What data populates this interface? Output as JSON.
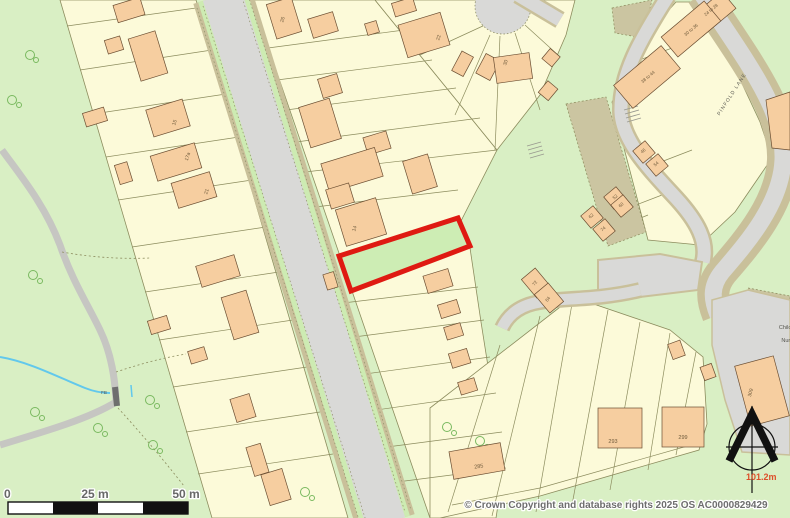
{
  "map": {
    "type": "os-site-plan",
    "copyright": "© Crown Copyright and database rights 2025 OS AC0000829429",
    "scale_bar": {
      "zero": "0",
      "mid": "25 m",
      "end": "50 m"
    },
    "spot_height": "101.2m",
    "street_name": "PINFOLD LANE",
    "plot_outline_color": "#DF1A12",
    "colors": {
      "open_green": "#D9EFC4",
      "parcel_cream": "#FCFAD9",
      "building_peach": "#F6CEA0",
      "road_grey": "#D9D9D7",
      "verge_green": "#CDEBB2",
      "road_casing": "#C9C09A",
      "scrub_khaki": "#CBC5A1",
      "stream_blue": "#62C8EC",
      "plot_red": "#DF1A12"
    },
    "labels": [
      {
        "id": "h15",
        "text": "15",
        "x": 176,
        "y": 123,
        "rot": -73,
        "size": 5,
        "color": "#6F5B3C"
      },
      {
        "id": "h17a",
        "text": "17a",
        "x": 189,
        "y": 157,
        "rot": -73,
        "size": 5,
        "color": "#6F5B3C"
      },
      {
        "id": "h21",
        "text": "21",
        "x": 208,
        "y": 192,
        "rot": -73,
        "size": 5,
        "color": "#6F5B3C"
      },
      {
        "id": "h26",
        "text": "26",
        "x": 284,
        "y": 20,
        "rot": -73,
        "size": 5,
        "color": "#6F5B3C"
      },
      {
        "id": "h22",
        "text": "22",
        "x": 440,
        "y": 38,
        "rot": -73,
        "size": 5,
        "color": "#6F5B3C"
      },
      {
        "id": "h30",
        "text": "30",
        "x": 507,
        "y": 63,
        "rot": -73,
        "size": 5,
        "color": "#6F5B3C"
      },
      {
        "id": "h14",
        "text": "14",
        "x": 356,
        "y": 229,
        "rot": -73,
        "size": 5,
        "color": "#6F5B3C"
      },
      {
        "id": "t2428",
        "text": "24 to 28",
        "x": 712,
        "y": 11,
        "rot": -40,
        "size": 4.5,
        "color": "#6F5B3C"
      },
      {
        "id": "t3036",
        "text": "30 to 36",
        "x": 692,
        "y": 31,
        "rot": -40,
        "size": 4.5,
        "color": "#6F5B3C"
      },
      {
        "id": "t3844",
        "text": "38 to 44",
        "x": 649,
        "y": 78,
        "rot": -40,
        "size": 4.5,
        "color": "#6F5B3C"
      },
      {
        "id": "h46",
        "text": "46",
        "x": 644,
        "y": 152,
        "rot": -40,
        "size": 4.5,
        "color": "#6F5B3C"
      },
      {
        "id": "h54",
        "text": "54",
        "x": 657,
        "y": 165,
        "rot": -40,
        "size": 4.5,
        "color": "#6F5B3C"
      },
      {
        "id": "h52",
        "text": "52",
        "x": 616,
        "y": 198,
        "rot": -40,
        "size": 4.5,
        "color": "#6F5B3C"
      },
      {
        "id": "h60",
        "text": "60",
        "x": 622,
        "y": 206,
        "rot": -40,
        "size": 4.5,
        "color": "#6F5B3C"
      },
      {
        "id": "h62",
        "text": "62",
        "x": 592,
        "y": 217,
        "rot": -40,
        "size": 4.5,
        "color": "#6F5B3C"
      },
      {
        "id": "h74",
        "text": "74",
        "x": 604,
        "y": 230,
        "rot": -40,
        "size": 4.5,
        "color": "#6F5B3C"
      },
      {
        "id": "h72",
        "text": "72",
        "x": 536,
        "y": 284,
        "rot": -55,
        "size": 4.5,
        "color": "#6F5B3C"
      },
      {
        "id": "h84",
        "text": "84",
        "x": 549,
        "y": 300,
        "rot": -55,
        "size": 4.5,
        "color": "#6F5B3C"
      },
      {
        "id": "h285",
        "text": "285",
        "x": 479,
        "y": 468,
        "rot": -8,
        "size": 5.5,
        "color": "#6F5B3C"
      },
      {
        "id": "h293",
        "text": "293",
        "x": 613,
        "y": 443,
        "rot": 0,
        "size": 5.5,
        "color": "#6F5B3C"
      },
      {
        "id": "h299",
        "text": "299",
        "x": 683,
        "y": 439,
        "rot": 0,
        "size": 5.5,
        "color": "#6F5B3C"
      },
      {
        "id": "h309",
        "text": "309",
        "x": 752,
        "y": 393,
        "rot": -75,
        "size": 5,
        "color": "#6F5B3C"
      },
      {
        "id": "street",
        "text": "PINFOLD LANE",
        "x": 733,
        "y": 95,
        "rot": -57,
        "size": 5,
        "color": "#55554E",
        "spacing": 1.1
      },
      {
        "id": "fb",
        "text": "FB",
        "x": 104,
        "y": 394,
        "rot": 0,
        "size": 4.5,
        "color": "#55554E"
      },
      {
        "id": "nursery1",
        "text": "Children's",
        "x": 791,
        "y": 329,
        "rot": 0,
        "size": 5.5,
        "color": "#55554E"
      },
      {
        "id": "nursery2",
        "text": "Nursery",
        "x": 791,
        "y": 342,
        "rot": 0,
        "size": 5.5,
        "color": "#55554E"
      },
      {
        "id": "spot",
        "text": "101.2m",
        "x": 746,
        "y": 480,
        "rot": 0,
        "size": 9,
        "color": "#DD4F2A",
        "anchor": "start",
        "bold": true
      },
      {
        "id": "scale0",
        "text": "0",
        "x": 4,
        "y": 498,
        "rot": 0,
        "size": 12,
        "color": "#686868",
        "anchor": "start",
        "bold": true,
        "halo": true
      },
      {
        "id": "scale25",
        "text": "25 m",
        "x": 95,
        "y": 498,
        "rot": 0,
        "size": 12,
        "color": "#686868",
        "bold": true,
        "halo": true
      },
      {
        "id": "scale50",
        "text": "50 m",
        "x": 186,
        "y": 498,
        "rot": 0,
        "size": 12,
        "color": "#686868",
        "bold": true,
        "halo": true
      },
      {
        "id": "copyright",
        "text": "© Crown Copyright and database rights 2025 OS AC0000829429",
        "x": 616,
        "y": 508,
        "rot": 0,
        "size": 10,
        "color": "#6E6E6E",
        "bold": true,
        "halo": true
      }
    ]
  }
}
